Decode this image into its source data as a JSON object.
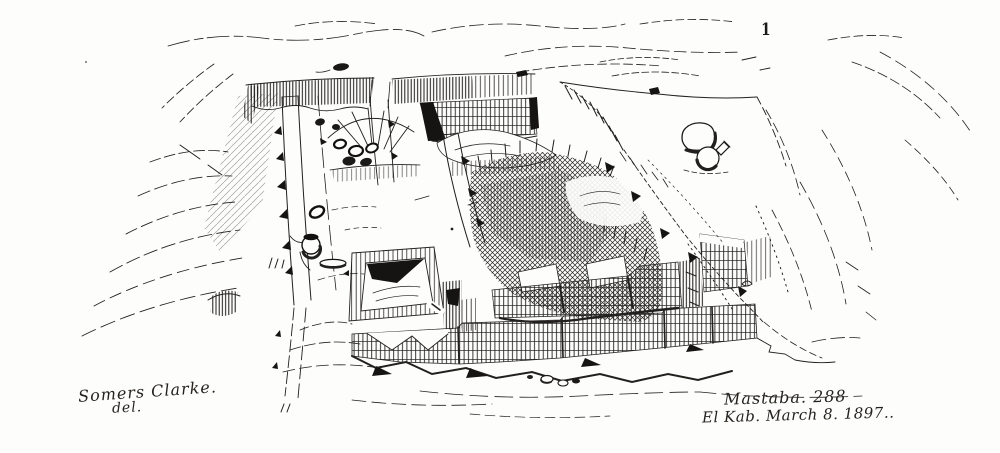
{
  "figure": {
    "plate_number": "1",
    "title": "Mastaba. 288",
    "locality_date": "El Kab. March 8. 1897..",
    "signature": "Somers Clarke.",
    "signature_credit": "del.",
    "description": "Pen-and-ink perspective field sketch of excavated mastaba tomb 288 at El Kab: rectangular excavation pit with hatched rim, long trench walls, dark cross-hatched burial chamber, stepped brick walls, open shaft pit, pottery vessels and surrounding desert mounds.",
    "ink_color": "#1f1d1a",
    "paper_color": "#fdfdfb"
  }
}
